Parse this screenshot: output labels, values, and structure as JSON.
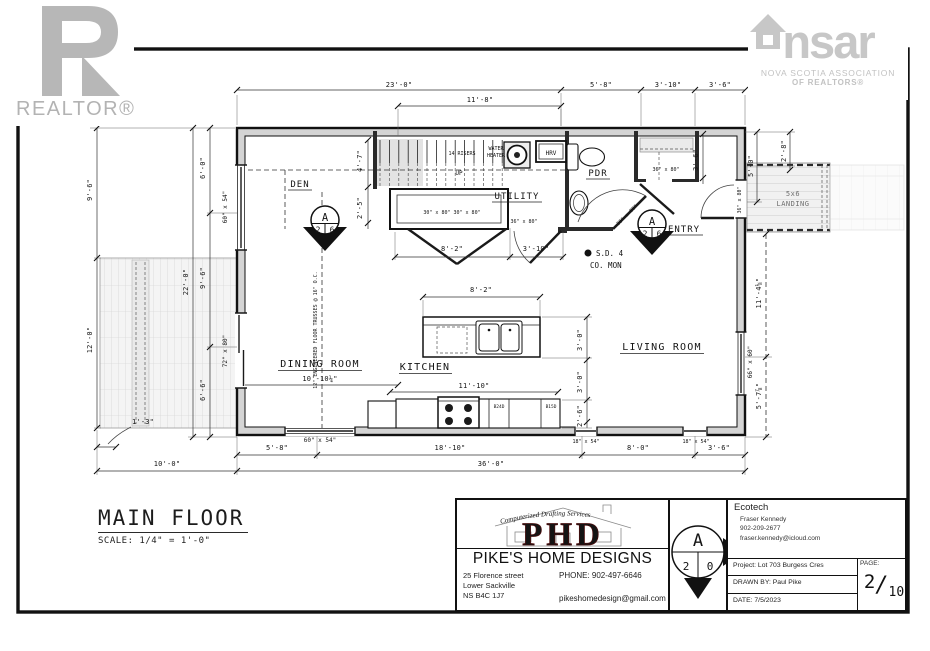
{
  "branding": {
    "realtor": "REALTOR®",
    "nsar_ns": "ns",
    "nsar_ar": "ar",
    "nsar_assoc": "NOVA SCOTIA ASSOCIATION",
    "nsar_of": "OF REALTORS®"
  },
  "sheet": {
    "title": "MAIN FLOOR",
    "scale": "SCALE: 1/4\" = 1'-0\""
  },
  "rooms": {
    "den": "DEN",
    "utility": "UTILITY",
    "pdr": "PDR",
    "entry": "ENTRY",
    "dining": "DINING ROOM",
    "kitchen": "KITCHEN",
    "living": "LIVING ROOM"
  },
  "stairs": {
    "risers": "14 RISERS",
    "up": "UP",
    "water1": "WATER",
    "water2": "HEATER",
    "hrv": "HRV"
  },
  "notes": {
    "sd": "S.D. 4",
    "co": "CO. MON",
    "landing1": "5x6",
    "landing2": "LANDING",
    "truss": "12\" ENGINEERED FLOOR TRUSSES @ 16\" O.C.",
    "b24d": "B24D",
    "b15d": "B15D",
    "dining_size": "10'-10¼\""
  },
  "dims": {
    "d23": "23'-0\"",
    "d11_8": "11'-8\"",
    "d5_8t": "5'-8\"",
    "d3_10t": "3'-10\"",
    "d3_6t": "3'-6\"",
    "d9_6l": "9'-6\"",
    "d12l": "12'-0\"",
    "d22l": "22'-0\"",
    "d6_0l": "6'-0\"",
    "d9_6l2": "9'-6\"",
    "d6_6l": "6'-6\"",
    "d5_0r": "5'-0\"",
    "d2_8r": "2'-8\"",
    "d11_4r": "11'-4⅛\"",
    "d5_7r": "5'-7⅞\"",
    "d5_8b": "5'-8\"",
    "d18_10b": "18'-10\"",
    "d8_0b": "8'-0\"",
    "d3_6b": "3'-6\"",
    "d36b": "36'-0\"",
    "d10b": "10'-0\"",
    "d1_3b": "1'-3\"",
    "d8_2h": "8'-2\"",
    "d3_10h": "3'-10\"",
    "d8_2i": "8'-2\"",
    "d3_0a": "3'-0\"",
    "d3_0b2": "3'-0\"",
    "d2_6c": "2'-6\"",
    "d11_10k": "11'-10\"",
    "d4_7s": "4'-7\"",
    "d2_5s": "2'-5\"",
    "d3_6e": "3'-6\""
  },
  "openings": {
    "w60l": "60\" x 54\"",
    "d72l": "72\" x 80\"",
    "w60b": "60\" x 54\"",
    "w18a": "18\" x 54\"",
    "w18b": "18\" x 54\"",
    "w66r": "66\" x 60\"",
    "d30x2": "30\" x 80\" 30\" x 80\"",
    "d36h": "36\" x 80\"",
    "d36p": "36\" x 80\"",
    "d36c": "36\" x 80\"",
    "d36f": "36\" x 80\""
  },
  "markers": {
    "m1": {
      "top": "A",
      "l": "2",
      "r": "6"
    },
    "m2": {
      "top": "A",
      "l": "2",
      "r": "6"
    },
    "tb": {
      "top": "A",
      "l": "2",
      "r": "0"
    }
  },
  "titleblock": {
    "arc": "Computerized Drafting Services",
    "phd": "PHD",
    "company": "PIKE'S HOME DESIGNS",
    "addr1": "25 Florence street",
    "addr2": "Lower Sackville",
    "addr3": "NS B4C 1J7",
    "phone": "PHONE: 902-497-6646",
    "email": "pikeshomedesign@gmail.com",
    "client": "Ecotech",
    "contact": "Fraser Kennedy",
    "contact_phone": "902-209-2677",
    "contact_email": "fraser.kennedy@icloud.com",
    "project": "Project: Lot 703 Burgess Cres",
    "drawn": "DRAWN BY:  Paul Pike",
    "date": "DATE: 7/5/2023",
    "page_label": "PAGE:",
    "page": "2",
    "page_total": "10"
  },
  "colors": {
    "accent_red": "#8f1b1b",
    "logo_gray": "#c2c2c2",
    "wall_gray": "#d4d4d4"
  }
}
